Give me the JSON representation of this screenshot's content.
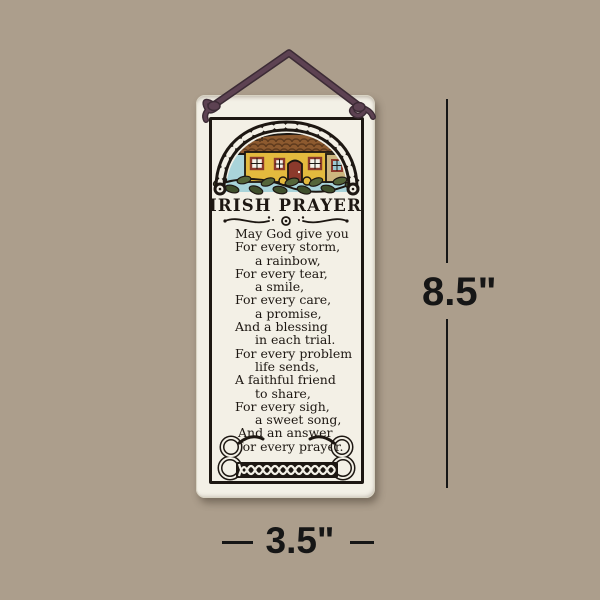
{
  "plaque": {
    "title": "IRISH PRAYER",
    "prayer_lines": [
      "May God give you",
      "For every storm,",
      "a rainbow,",
      "For every tear,",
      "a smile,",
      "For every care,",
      "a promise,",
      "And a blessing",
      "in each trial.",
      "For every problem",
      "life sends,",
      "A faithful friend",
      "to share,",
      "For every sigh,",
      "a sweet song,",
      "And an answer",
      "for every prayer."
    ]
  },
  "annotations": {
    "height_label": "8.5\"",
    "width_label": "3.5\""
  },
  "icons": {
    "hanging_cord": "plum-cord-with-knots",
    "cottage_scene": "irish-cottage-under-celtic-arch",
    "divider": "calligraphic-flourish",
    "bottom_border": "celtic-knot-braid"
  },
  "colors": {
    "background": "#ac9e8c",
    "plaque": "#f3f0e6",
    "ink": "#1d1712",
    "cord": "#5d4252",
    "cord_outline": "#3c2b35",
    "sky": "#a9d4da",
    "roof": "#8d5a2f",
    "roof_shade": "#5e3a1d",
    "wall": "#e4ba3e",
    "trim_red": "#8c3a2c",
    "gable": "#cdb67f",
    "leaf": "#55653a",
    "leaf_dark": "#3f4f2c",
    "dimension": "#161616"
  }
}
